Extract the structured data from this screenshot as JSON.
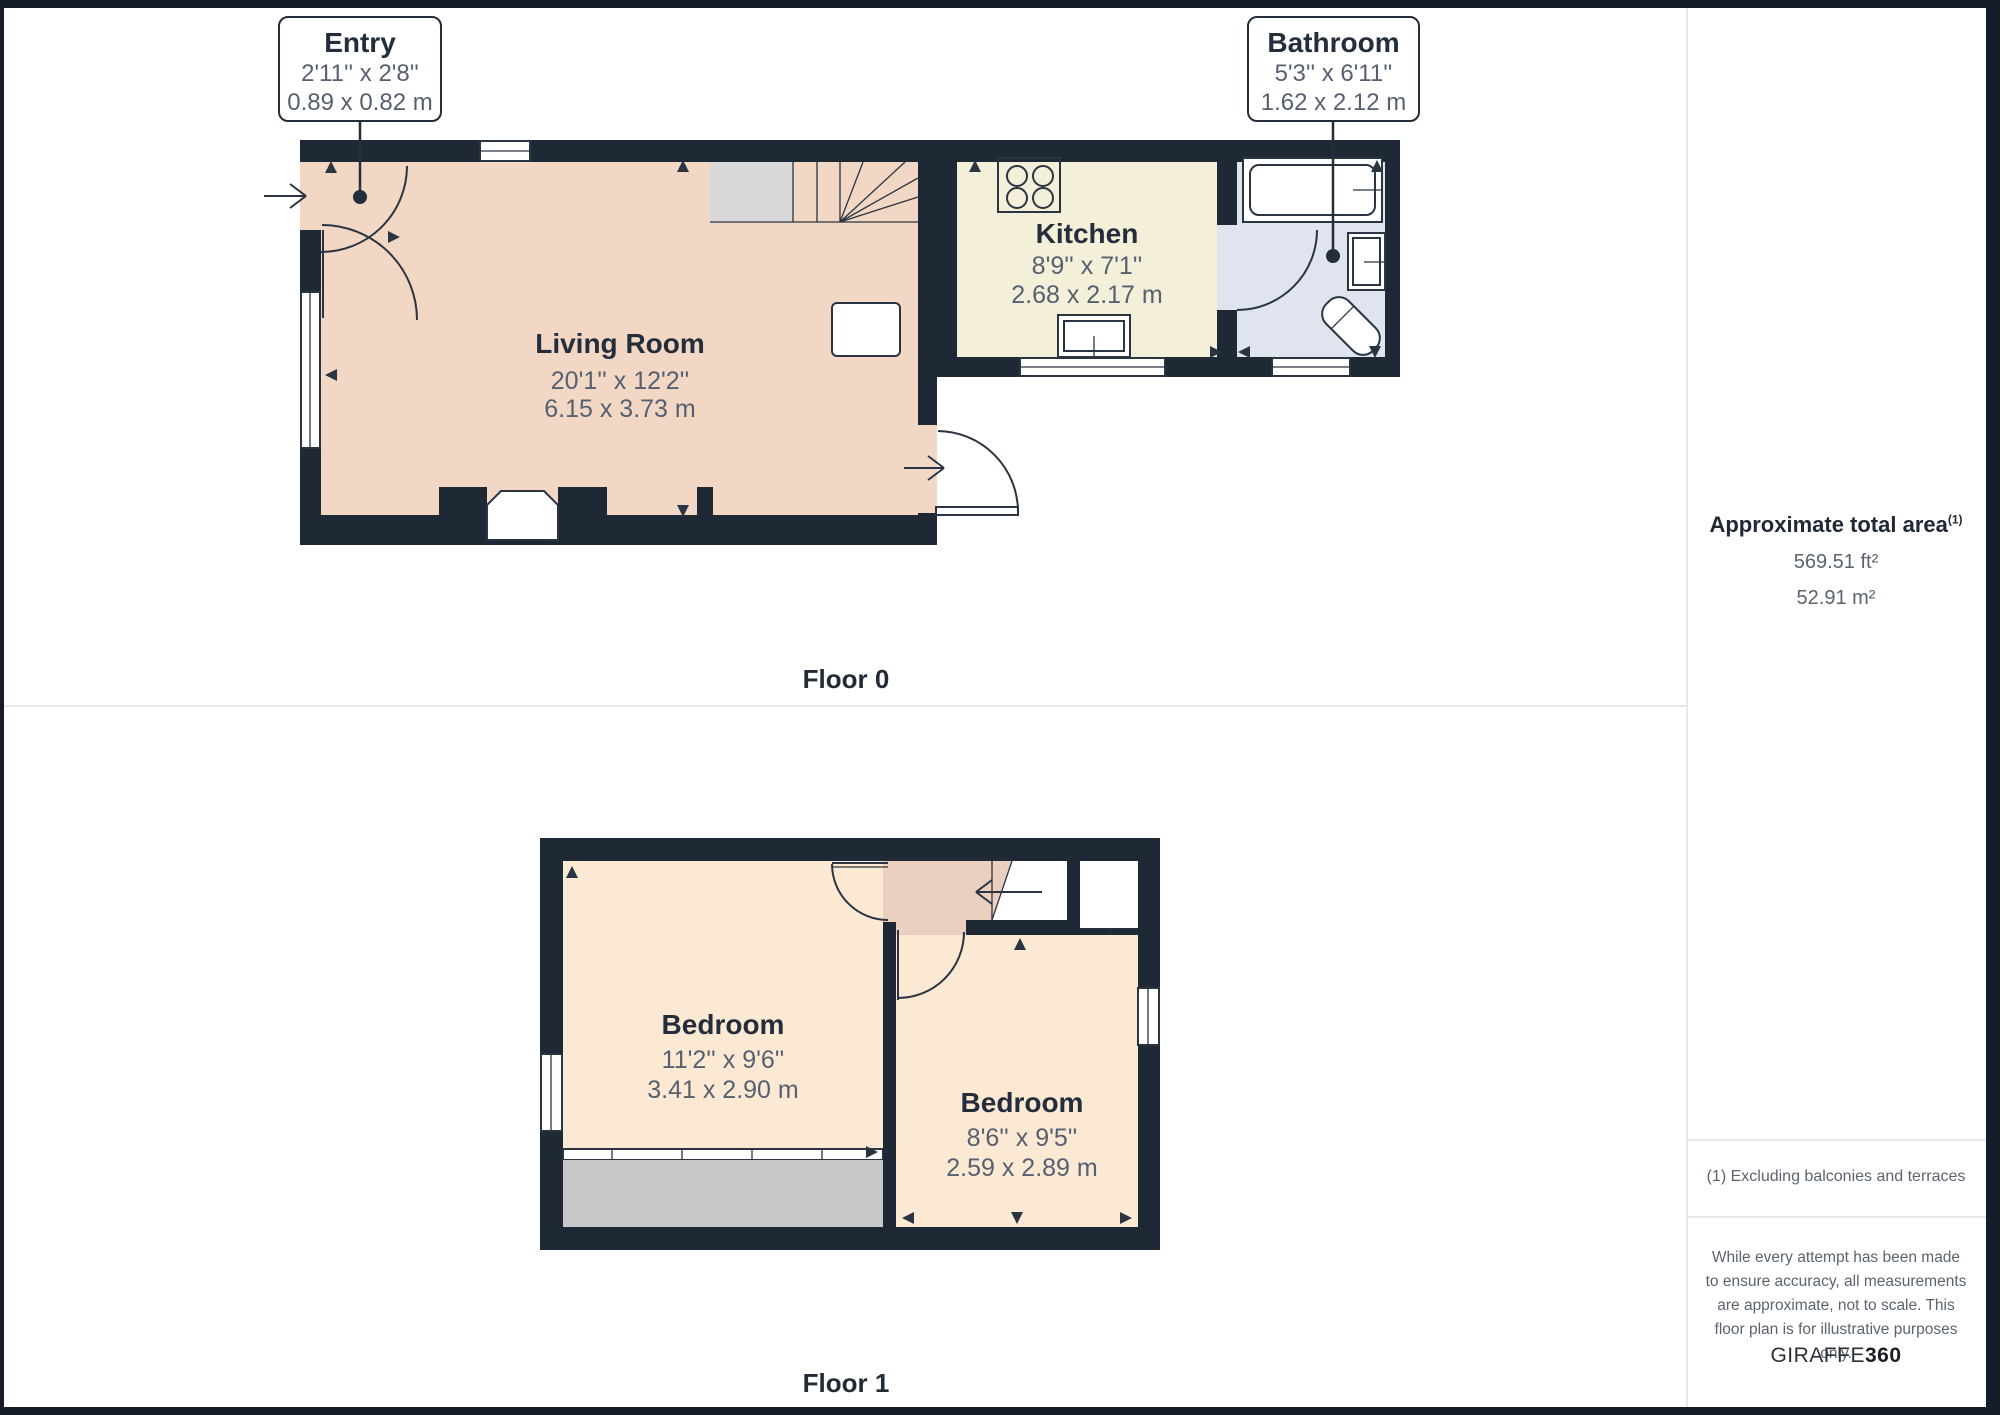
{
  "callouts": {
    "entry": {
      "title": "Entry",
      "imperial": "2'11'' x 2'8''",
      "metric": "0.89 x 0.82 m"
    },
    "bathroom": {
      "title": "Bathroom",
      "imperial": "5'3'' x 6'11''",
      "metric": "1.62 x 2.12 m"
    }
  },
  "floor0": {
    "label": "Floor 0",
    "rooms": {
      "living_room": {
        "name": "Living Room",
        "imperial": "20'1'' x 12'2''",
        "metric": "6.15 x 3.73 m"
      },
      "kitchen": {
        "name": "Kitchen",
        "imperial": "8'9'' x 7'1''",
        "metric": "2.68 x 2.17 m"
      }
    }
  },
  "floor1": {
    "label": "Floor 1",
    "rooms": {
      "bedroom_left": {
        "name": "Bedroom",
        "imperial": "11'2'' x 9'6''",
        "metric": "3.41 x 2.90 m"
      },
      "bedroom_right": {
        "name": "Bedroom",
        "imperial": "8'6'' x 9'5''",
        "metric": "2.59 x 2.89 m"
      }
    }
  },
  "sidebar": {
    "area_heading": "Approximate total area",
    "area_footnote_marker": "(1)",
    "area_ft": "569.51 ft²",
    "area_m": "52.91 m²",
    "footnote": "(1) Excluding balconies and terraces",
    "disclaimer": "While every attempt has been made to ensure accuracy, all measurements are approximate, not to scale. This floor plan is for illustrative purposes only.",
    "brand_primary": "GIRAFFE",
    "brand_secondary": "360"
  },
  "colors": {
    "wall": "#1f2936",
    "living": "#f2d7c5",
    "kitchen": "#f4efd9",
    "bathroom": "#dfe4ef",
    "bedroom": "#fce9d4",
    "landing": "#ecd0bf",
    "stairgray": "#d8d8d8",
    "eavesgray": "#c8c8c9",
    "line": "#2a3442",
    "text-dark": "#232d3b",
    "text-dim": "#566070",
    "divider": "#e8e8e8",
    "frame": "#151c27"
  }
}
